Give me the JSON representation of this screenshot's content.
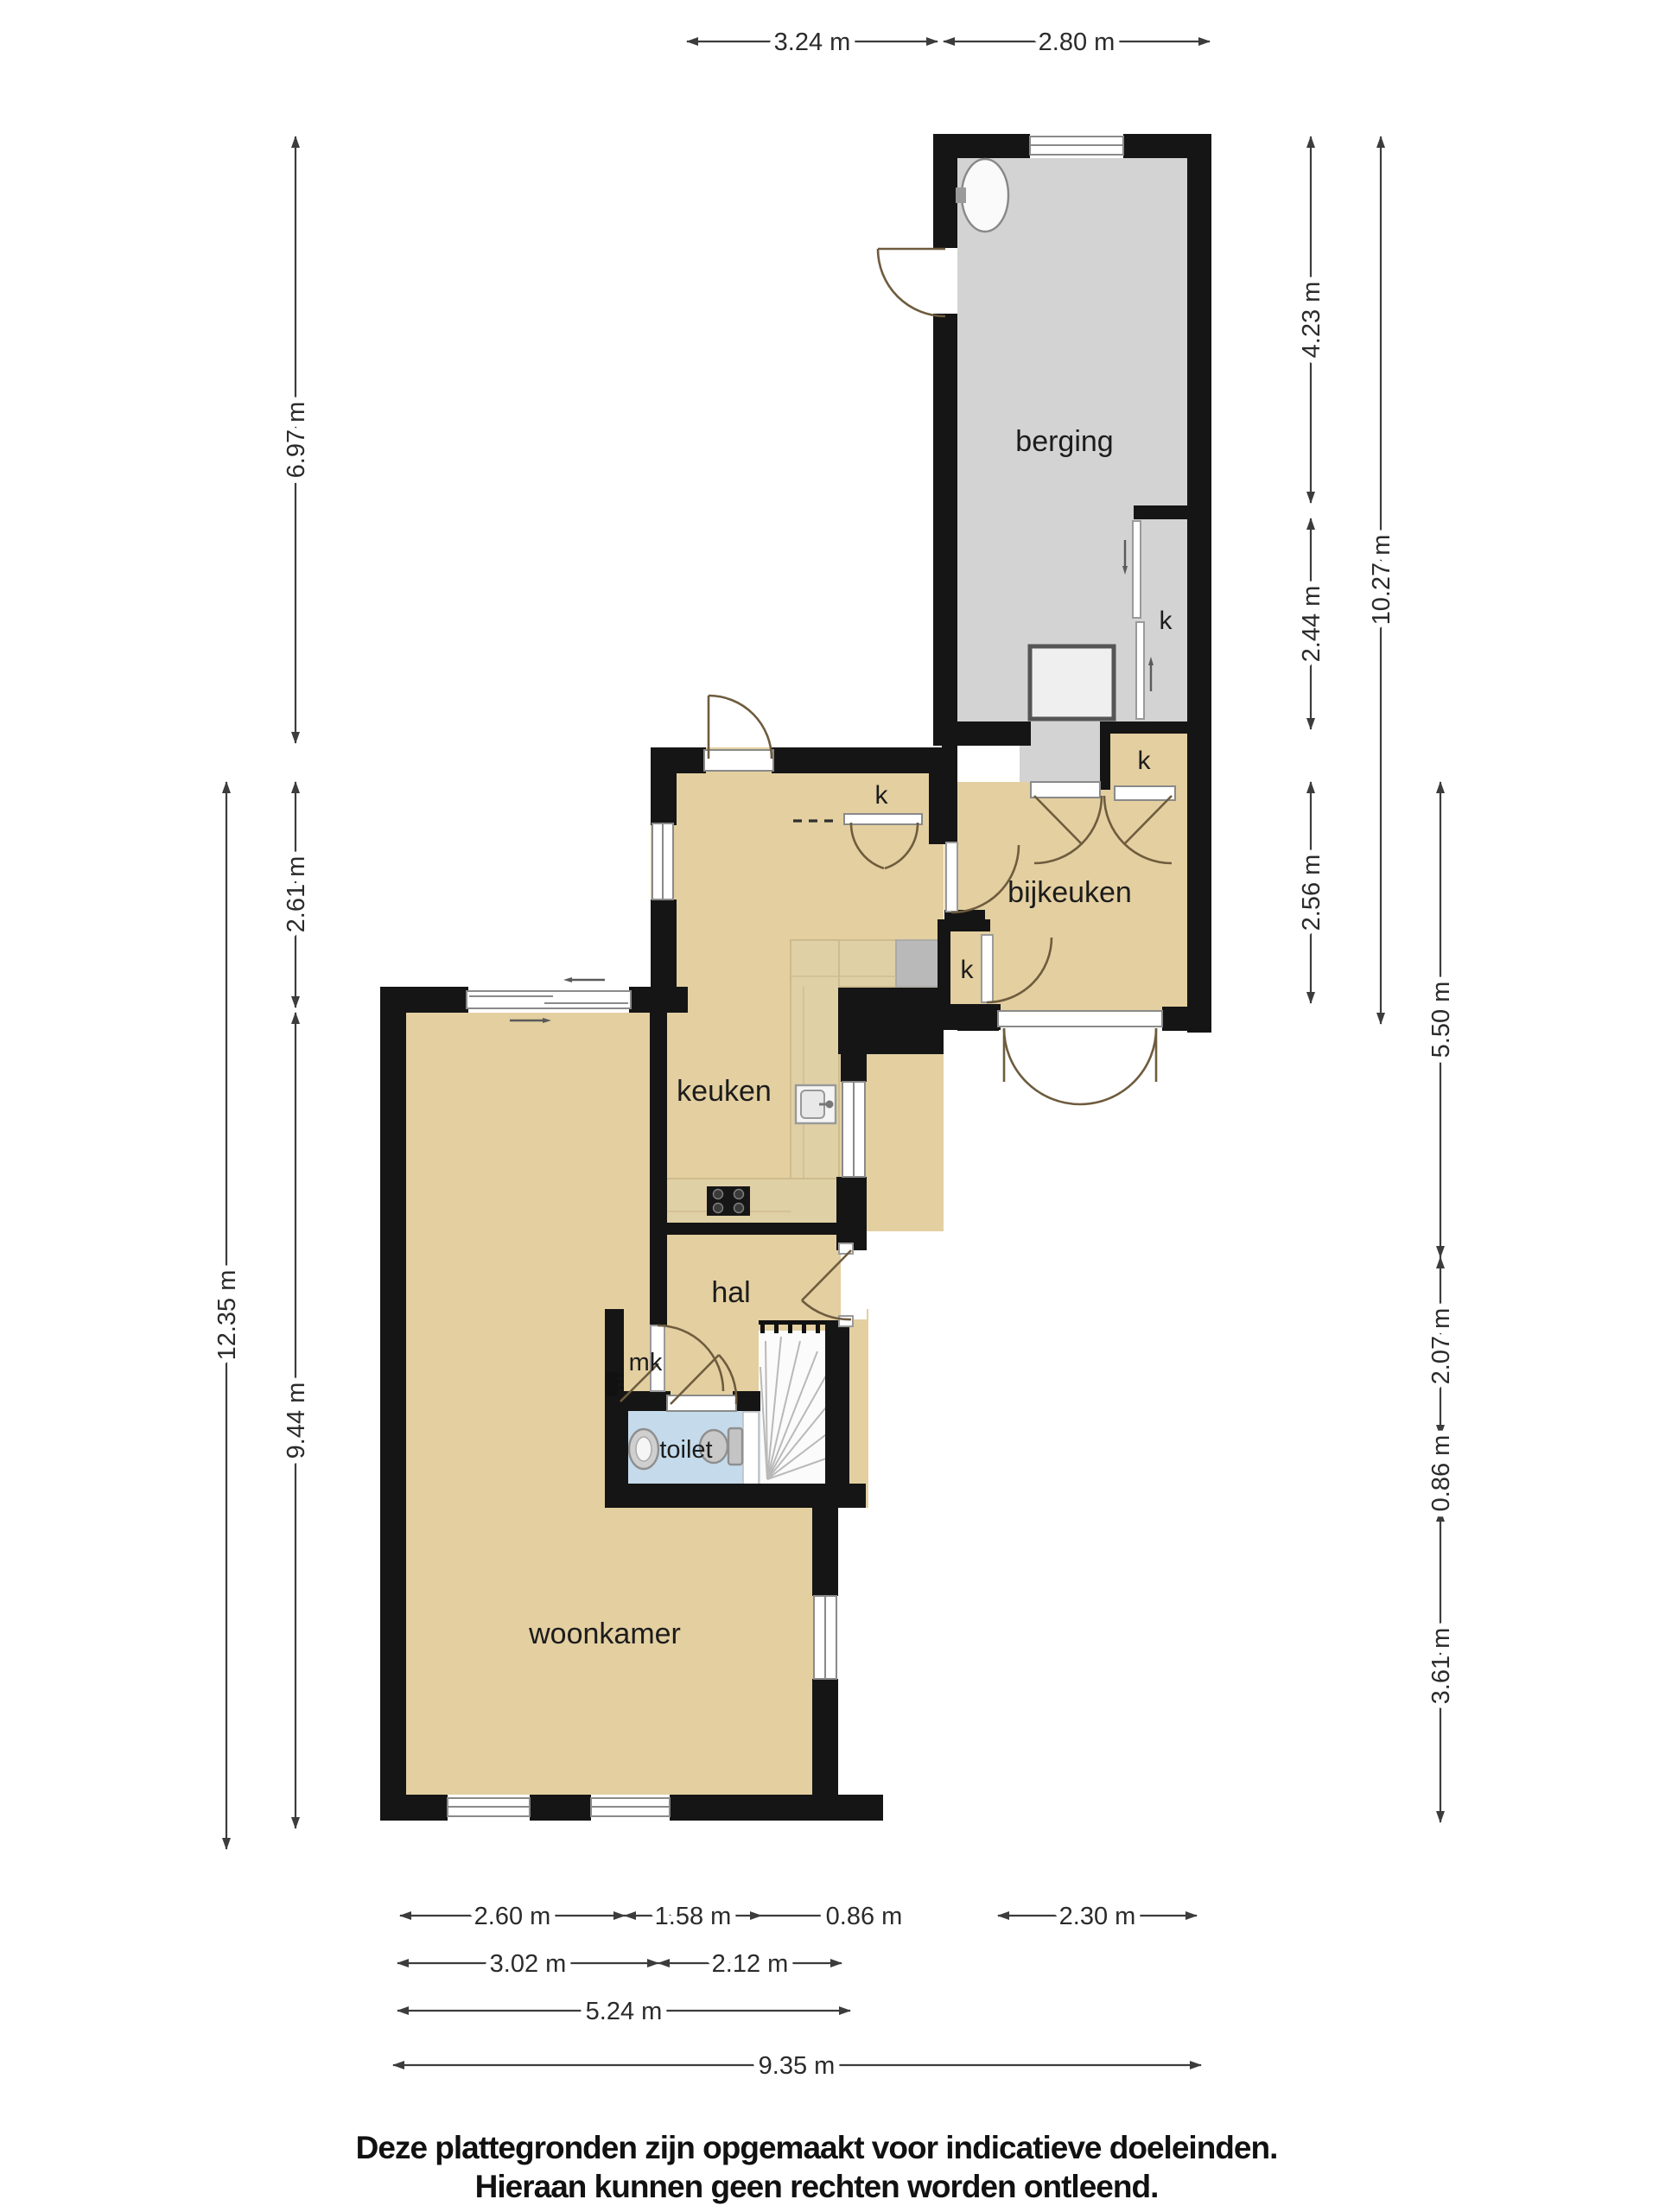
{
  "plan": {
    "type": "floor-plan",
    "rooms": {
      "berging": "berging",
      "bijkeuken": "bijkeuken",
      "keuken": "keuken",
      "hal": "hal",
      "toilet": "toilet",
      "woonkamer": "woonkamer",
      "meterkast": "mk",
      "closet": "k"
    },
    "fixtures": [
      "washer",
      "sink",
      "cooktop",
      "kitchen-sink",
      "washbasin",
      "toilet-bowl",
      "stairs"
    ],
    "colors": {
      "wall": "#151515",
      "room_floor": "#E3CFA0",
      "storage_floor": "#D3D3D3",
      "toilet_floor": "#C5DBEC",
      "counter_wood": "#E0D0A6",
      "counter_gray": "#B9B9B9",
      "door_swing": "#6E5C3E",
      "dimension_line": "#3C3C3C"
    }
  },
  "dims": {
    "top": [
      "3.24 m",
      "2.80 m"
    ],
    "left": [
      "6.97 m",
      "2.61 m",
      "12.35 m",
      "9.44 m"
    ],
    "right": [
      "4.23 m",
      "2.44 m",
      "2.56 m",
      "10.27 m",
      "5.50 m",
      "2.07 m",
      "0.86 m",
      "3.61 m"
    ],
    "bottom_row1": [
      "2.60 m",
      "1.58 m",
      "0.86 m",
      "2.30 m"
    ],
    "bottom_row2": [
      "3.02 m",
      "2.12 m"
    ],
    "bottom_row3": [
      "5.24 m"
    ],
    "bottom_row4": [
      "9.35 m"
    ]
  },
  "footer": {
    "line1": "Deze plattegronden zijn opgemaakt voor indicatieve doeleinden.",
    "line2": "Hieraan kunnen geen rechten worden ontleend."
  }
}
